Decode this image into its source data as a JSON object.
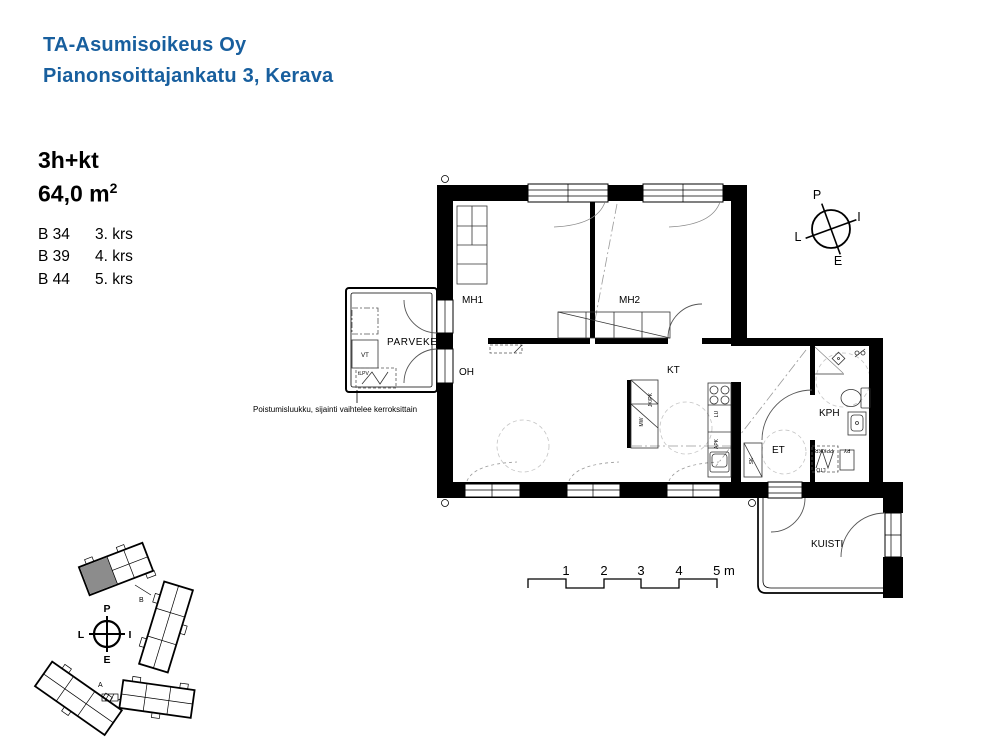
{
  "header": {
    "company": "TA-Asumisoikeus Oy",
    "address": "Pianonsoittajankatu 3, Kerava",
    "brand_color": "#185f9e"
  },
  "apartment": {
    "type": "3h+kt",
    "area_value": "64,0 m",
    "area_sup": "2",
    "units": [
      {
        "id": "B 34",
        "floor": "3. krs"
      },
      {
        "id": "B 39",
        "floor": "4. krs"
      },
      {
        "id": "B 44",
        "floor": "5. krs"
      }
    ]
  },
  "note": {
    "text": "Poistumisluukku, sijainti vaihtelee kerroksittain"
  },
  "rooms": {
    "mh1": "MH1",
    "mh2": "MH2",
    "parveke": "PARVEKE",
    "oh": "OH",
    "kt": "KT",
    "kph": "KPH",
    "et": "ET",
    "kuisti": "KUISTI"
  },
  "fixtures": {
    "vt": "VT",
    "hatch": "tLPV",
    "fridge": "JK/PK",
    "micro": "MW",
    "stove": "LU",
    "dishwasher": "APK",
    "cleaning_closet": "SK",
    "laundry": "PPK/KR",
    "dryer": "PY",
    "heat_recovery": "LTO"
  },
  "compass": {
    "north": "P",
    "east": "I",
    "south": "E",
    "west": "L"
  },
  "scale_bar": {
    "t1": "1",
    "t2": "2",
    "t3": "3",
    "t4": "4",
    "end": "5 m"
  },
  "site_plan": {
    "label_a": "A",
    "label_b": "B",
    "highlight_color": "#8c8c8c"
  }
}
